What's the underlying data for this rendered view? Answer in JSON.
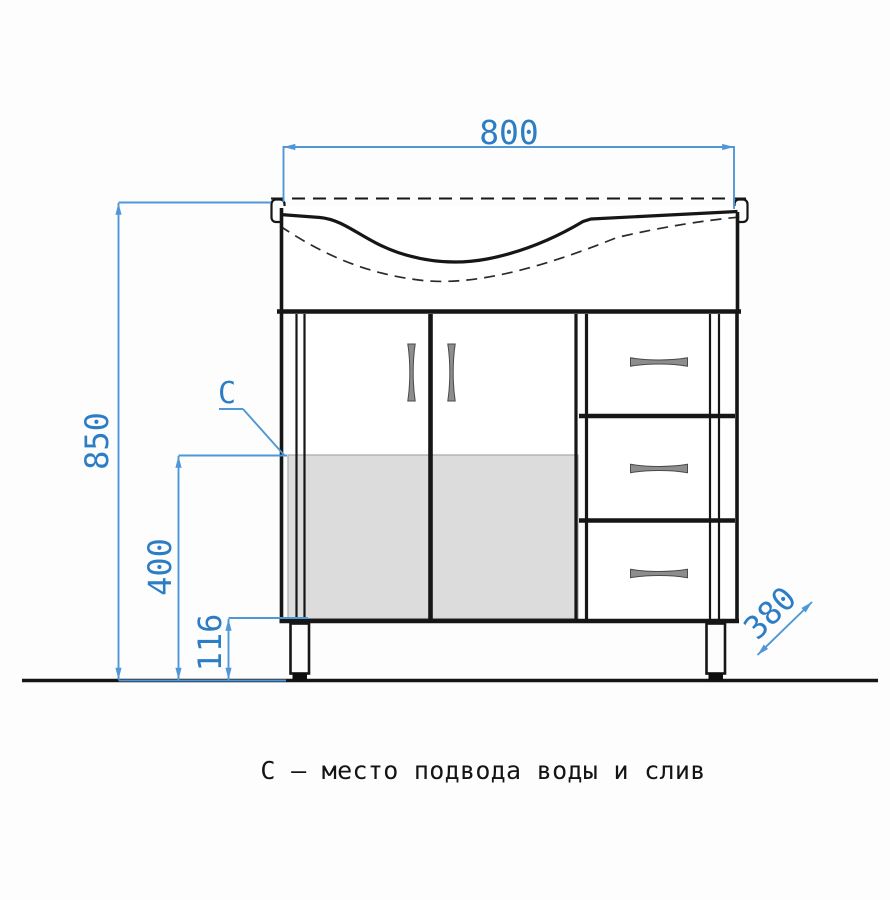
{
  "figure": {
    "caption": "С – место подвода воды и слив",
    "zone_marker": "C",
    "dims": {
      "width": "800",
      "height": "850",
      "zone_height": "400",
      "bottom_clearance": "116",
      "depth": "380"
    },
    "colors": {
      "dimension_text": "#2d7dc5",
      "dimension_line": "#4f97d6",
      "drawing_outline": "#161616",
      "zone_fill": "#dcdcdc",
      "handle_fill": "#8d8d8d"
    }
  }
}
